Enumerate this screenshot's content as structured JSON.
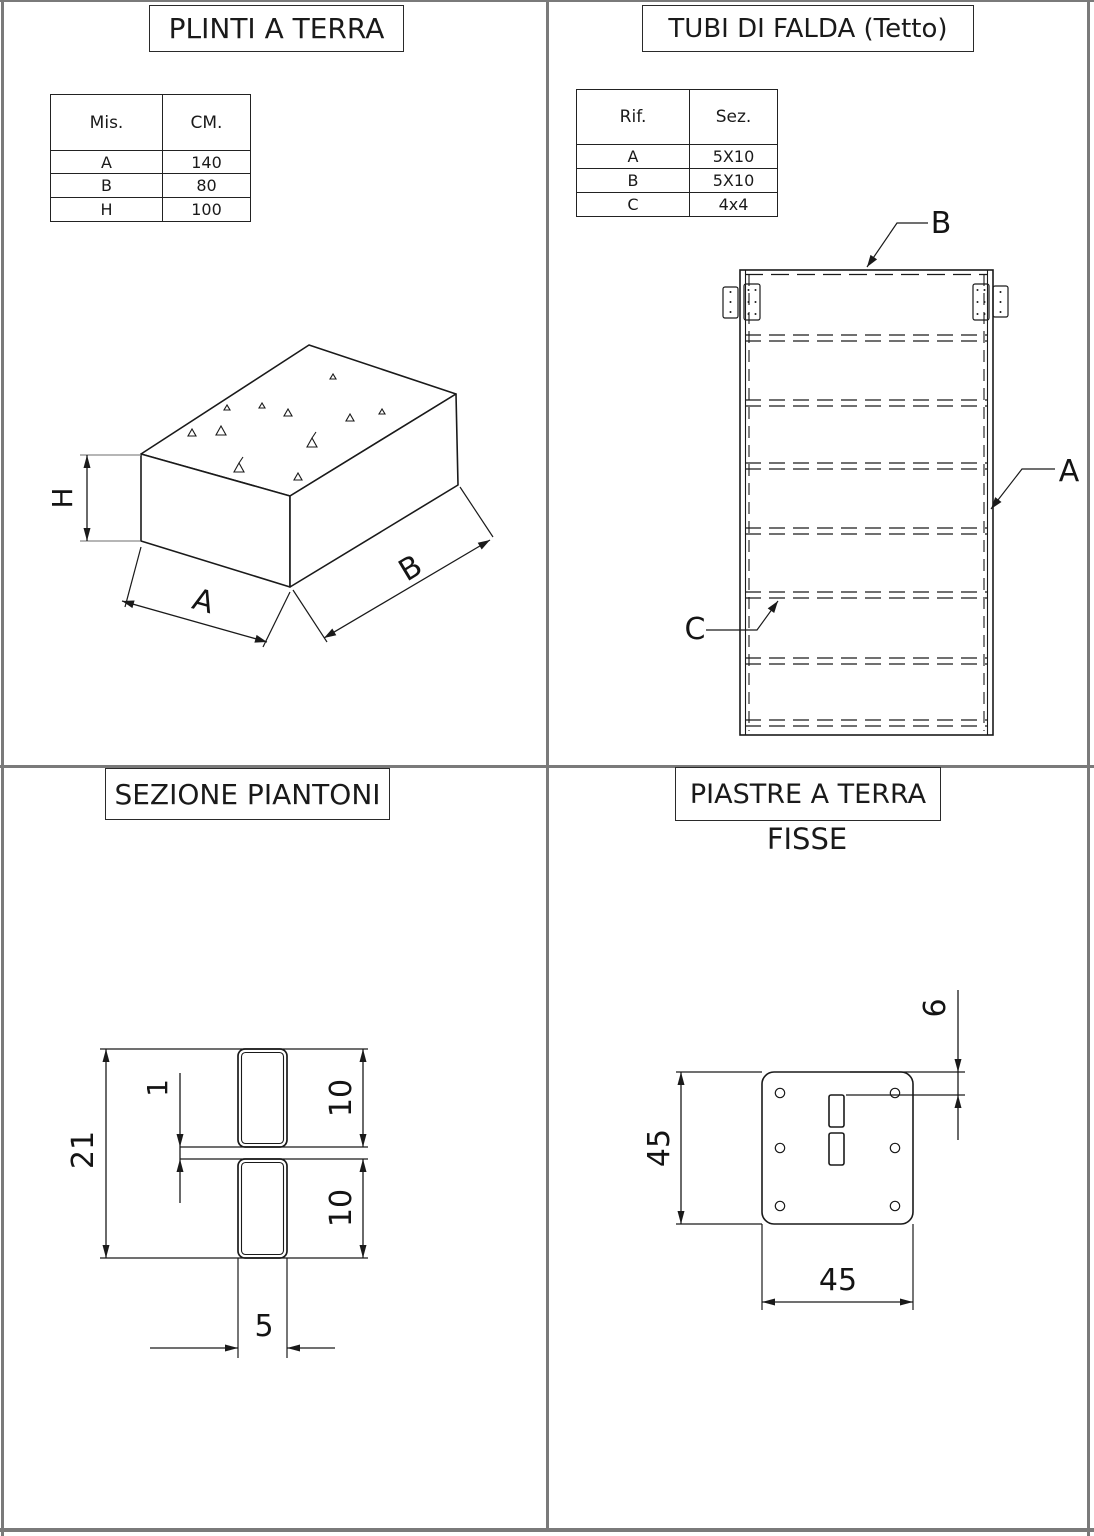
{
  "colors": {
    "line": "#1a1a1a",
    "frame_border": "#7a7a7a",
    "background": "#ffffff"
  },
  "quadrants": {
    "plinti": {
      "title": "PLINTI A TERRA",
      "table": {
        "headers": [
          "Mis.",
          "CM."
        ],
        "rows": [
          [
            "A",
            "140"
          ],
          [
            "B",
            "80"
          ],
          [
            "H",
            "100"
          ]
        ]
      },
      "labels": {
        "h": "H",
        "a": "A",
        "b": "B"
      }
    },
    "tubi": {
      "title": "TUBI DI FALDA (Tetto)",
      "table": {
        "headers": [
          "Rif.",
          "Sez."
        ],
        "rows": [
          [
            "A",
            "5X10"
          ],
          [
            "B",
            "5X10"
          ],
          [
            "C",
            "4x4"
          ]
        ]
      },
      "labels": {
        "a": "A",
        "b": "B",
        "c": "C"
      }
    },
    "sezione": {
      "title": "SEZIONE PIANTONI",
      "dims": {
        "total": "21",
        "gap": "1",
        "tube_top": "10",
        "tube_bottom": "10",
        "width": "5"
      }
    },
    "piastre": {
      "title": "PIASTRE A TERRA",
      "subtitle": "FISSE",
      "dims": {
        "height": "45",
        "width": "45",
        "offset": "6"
      }
    }
  }
}
